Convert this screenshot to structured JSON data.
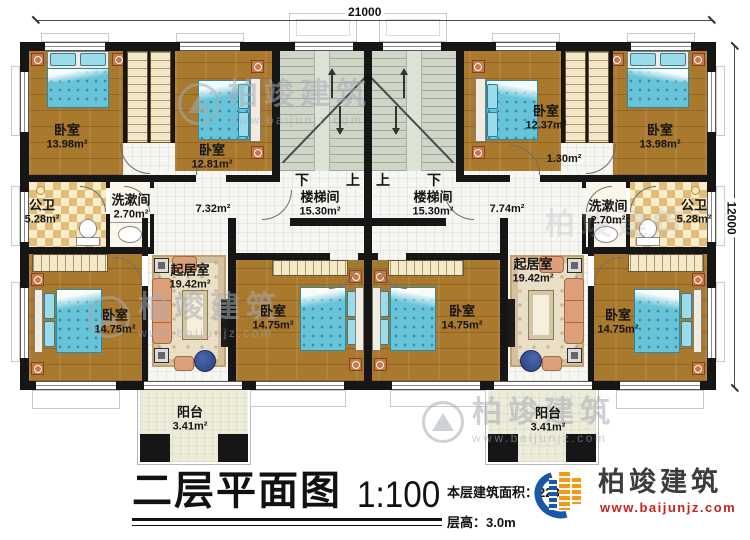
{
  "dims": {
    "top": "21000",
    "right": "12000"
  },
  "stairs": {
    "name": "楼梯间",
    "area": "15.30m²",
    "down": "下",
    "up": "上"
  },
  "rooms": {
    "l_br1": {
      "name": "卧室",
      "area": "13.98m²"
    },
    "l_br2": {
      "name": "卧室",
      "area": "12.81m²"
    },
    "l_bath": {
      "name": "公卫",
      "area": "5.28m²"
    },
    "l_wash": {
      "name": "洗漱间",
      "area": "2.70m²"
    },
    "l_hall": {
      "area": "7.32m²"
    },
    "l_living": {
      "name": "起居室",
      "area": "19.42m²"
    },
    "l_br3": {
      "name": "卧室",
      "area": "14.75m²"
    },
    "l_br4": {
      "name": "卧室",
      "area": "14.75m²"
    },
    "l_balcony": {
      "name": "阳台",
      "area": "3.41m²"
    },
    "r_br1": {
      "name": "卧室",
      "area": "12.37m²"
    },
    "r_br2": {
      "name": "卧室",
      "area": "13.98m²"
    },
    "r_niche": {
      "area": "1.30m²"
    },
    "r_wash": {
      "name": "洗漱间",
      "area": "2.70m²"
    },
    "r_bath": {
      "name": "公卫",
      "area": "5.28m²"
    },
    "r_hall": {
      "area": "7.74m²"
    },
    "r_living": {
      "name": "起居室",
      "area": "19.42m²"
    },
    "r_br3": {
      "name": "卧室",
      "area": "14.75m²"
    },
    "r_br4": {
      "name": "卧室",
      "area": "14.75m²"
    },
    "r_balcony": {
      "name": "阳台",
      "area": "3.41m²"
    }
  },
  "title": {
    "main": "二层平面图",
    "scale": "1:100",
    "floor_area": "本层建筑面积：223",
    "floor_height": "层高：3.0m"
  },
  "brand": {
    "name": "柏竣建筑",
    "site": "www.baijunjz.com"
  },
  "colors": {
    "wall": "#161616",
    "wood": "#a9792e",
    "bed": "#66c3d8",
    "logo_blue": "#1b57a8",
    "logo_orange": "#f09a18",
    "site_red": "#c9231c"
  }
}
